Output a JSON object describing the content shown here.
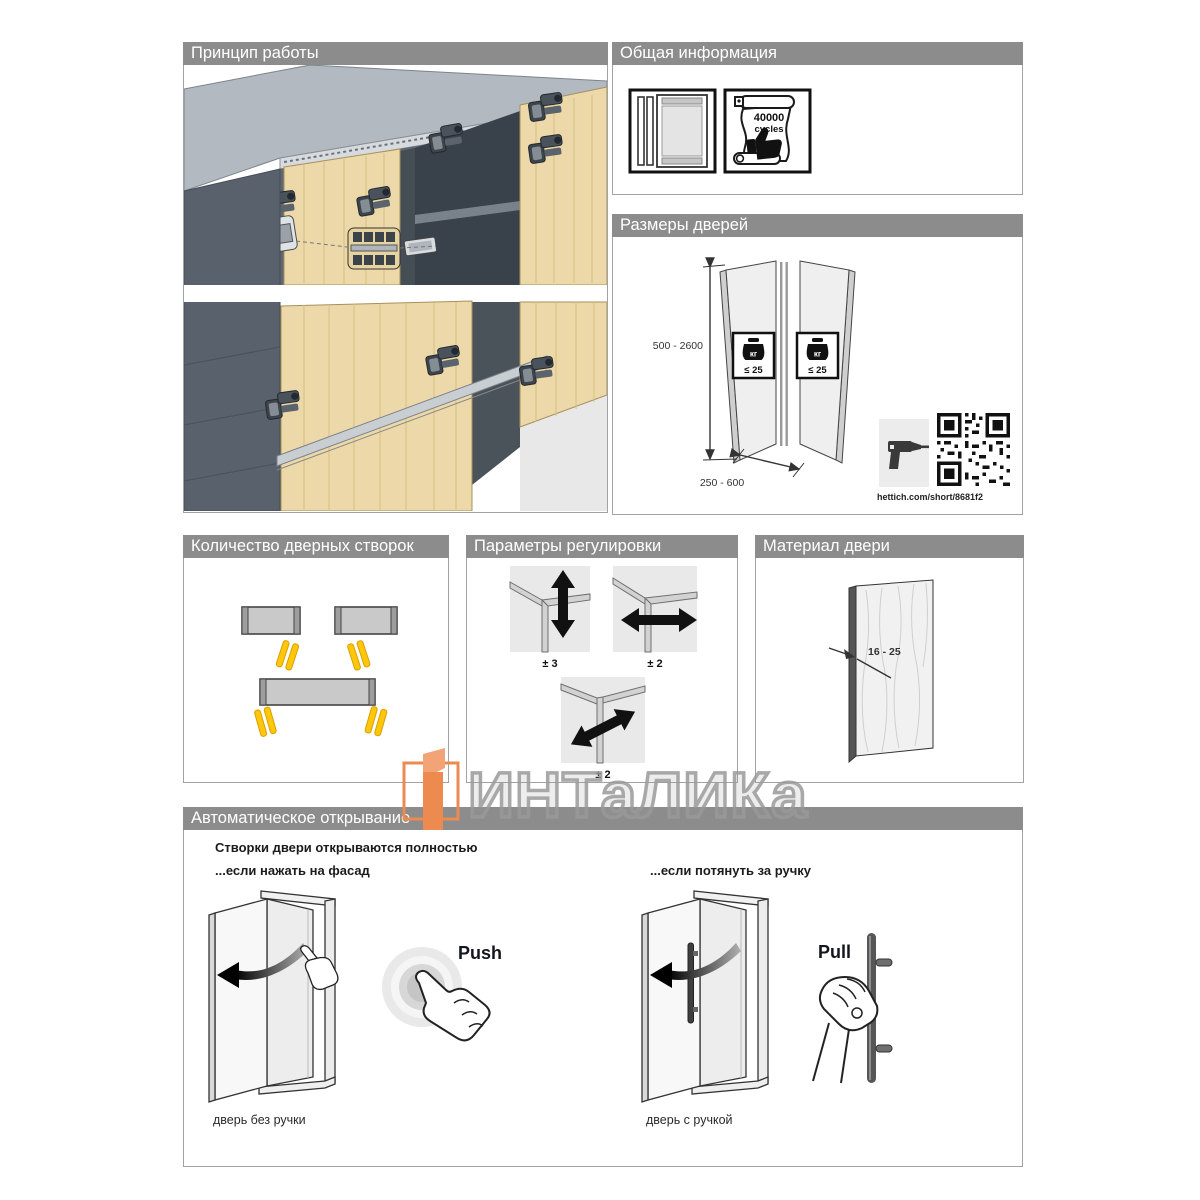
{
  "watermark": {
    "brand": "ИНТаЛИКа"
  },
  "principle": {
    "title": "Принцип работы"
  },
  "general": {
    "title": "Общая информация",
    "cycles_value": "40000",
    "cycles_unit": "cycles"
  },
  "sizes": {
    "title": "Размеры дверей",
    "height_range": "500 - 2600",
    "width_range": "250 - 600",
    "weight_unit": "кг",
    "weight_limit": "≤ 25",
    "qr_link": "hettich.com/short/8681f2"
  },
  "leaves": {
    "title": "Количество дверных створок"
  },
  "adjustment": {
    "title": "Параметры регулировки",
    "vertical": "± 3",
    "horizontal": "± 2",
    "depth": "± 2"
  },
  "material": {
    "title": "Материал двери",
    "thickness_range": "16 - 25"
  },
  "auto_opening": {
    "title": "Автоматическое открывание",
    "headline": "Створки двери открываются полностью",
    "push_condition": "...если нажать на фасад",
    "pull_condition": "...если потянуть за ручку",
    "push_label": "Push",
    "pull_label": "Pull",
    "push_caption": "дверь без ручки",
    "pull_caption": "дверь с ручкой"
  },
  "colors": {
    "header_bg": "#8c8c8c",
    "accent_yellow": "#ffc60a",
    "wood": "#ecd8a8",
    "brand_orange": "#ed8a50"
  }
}
